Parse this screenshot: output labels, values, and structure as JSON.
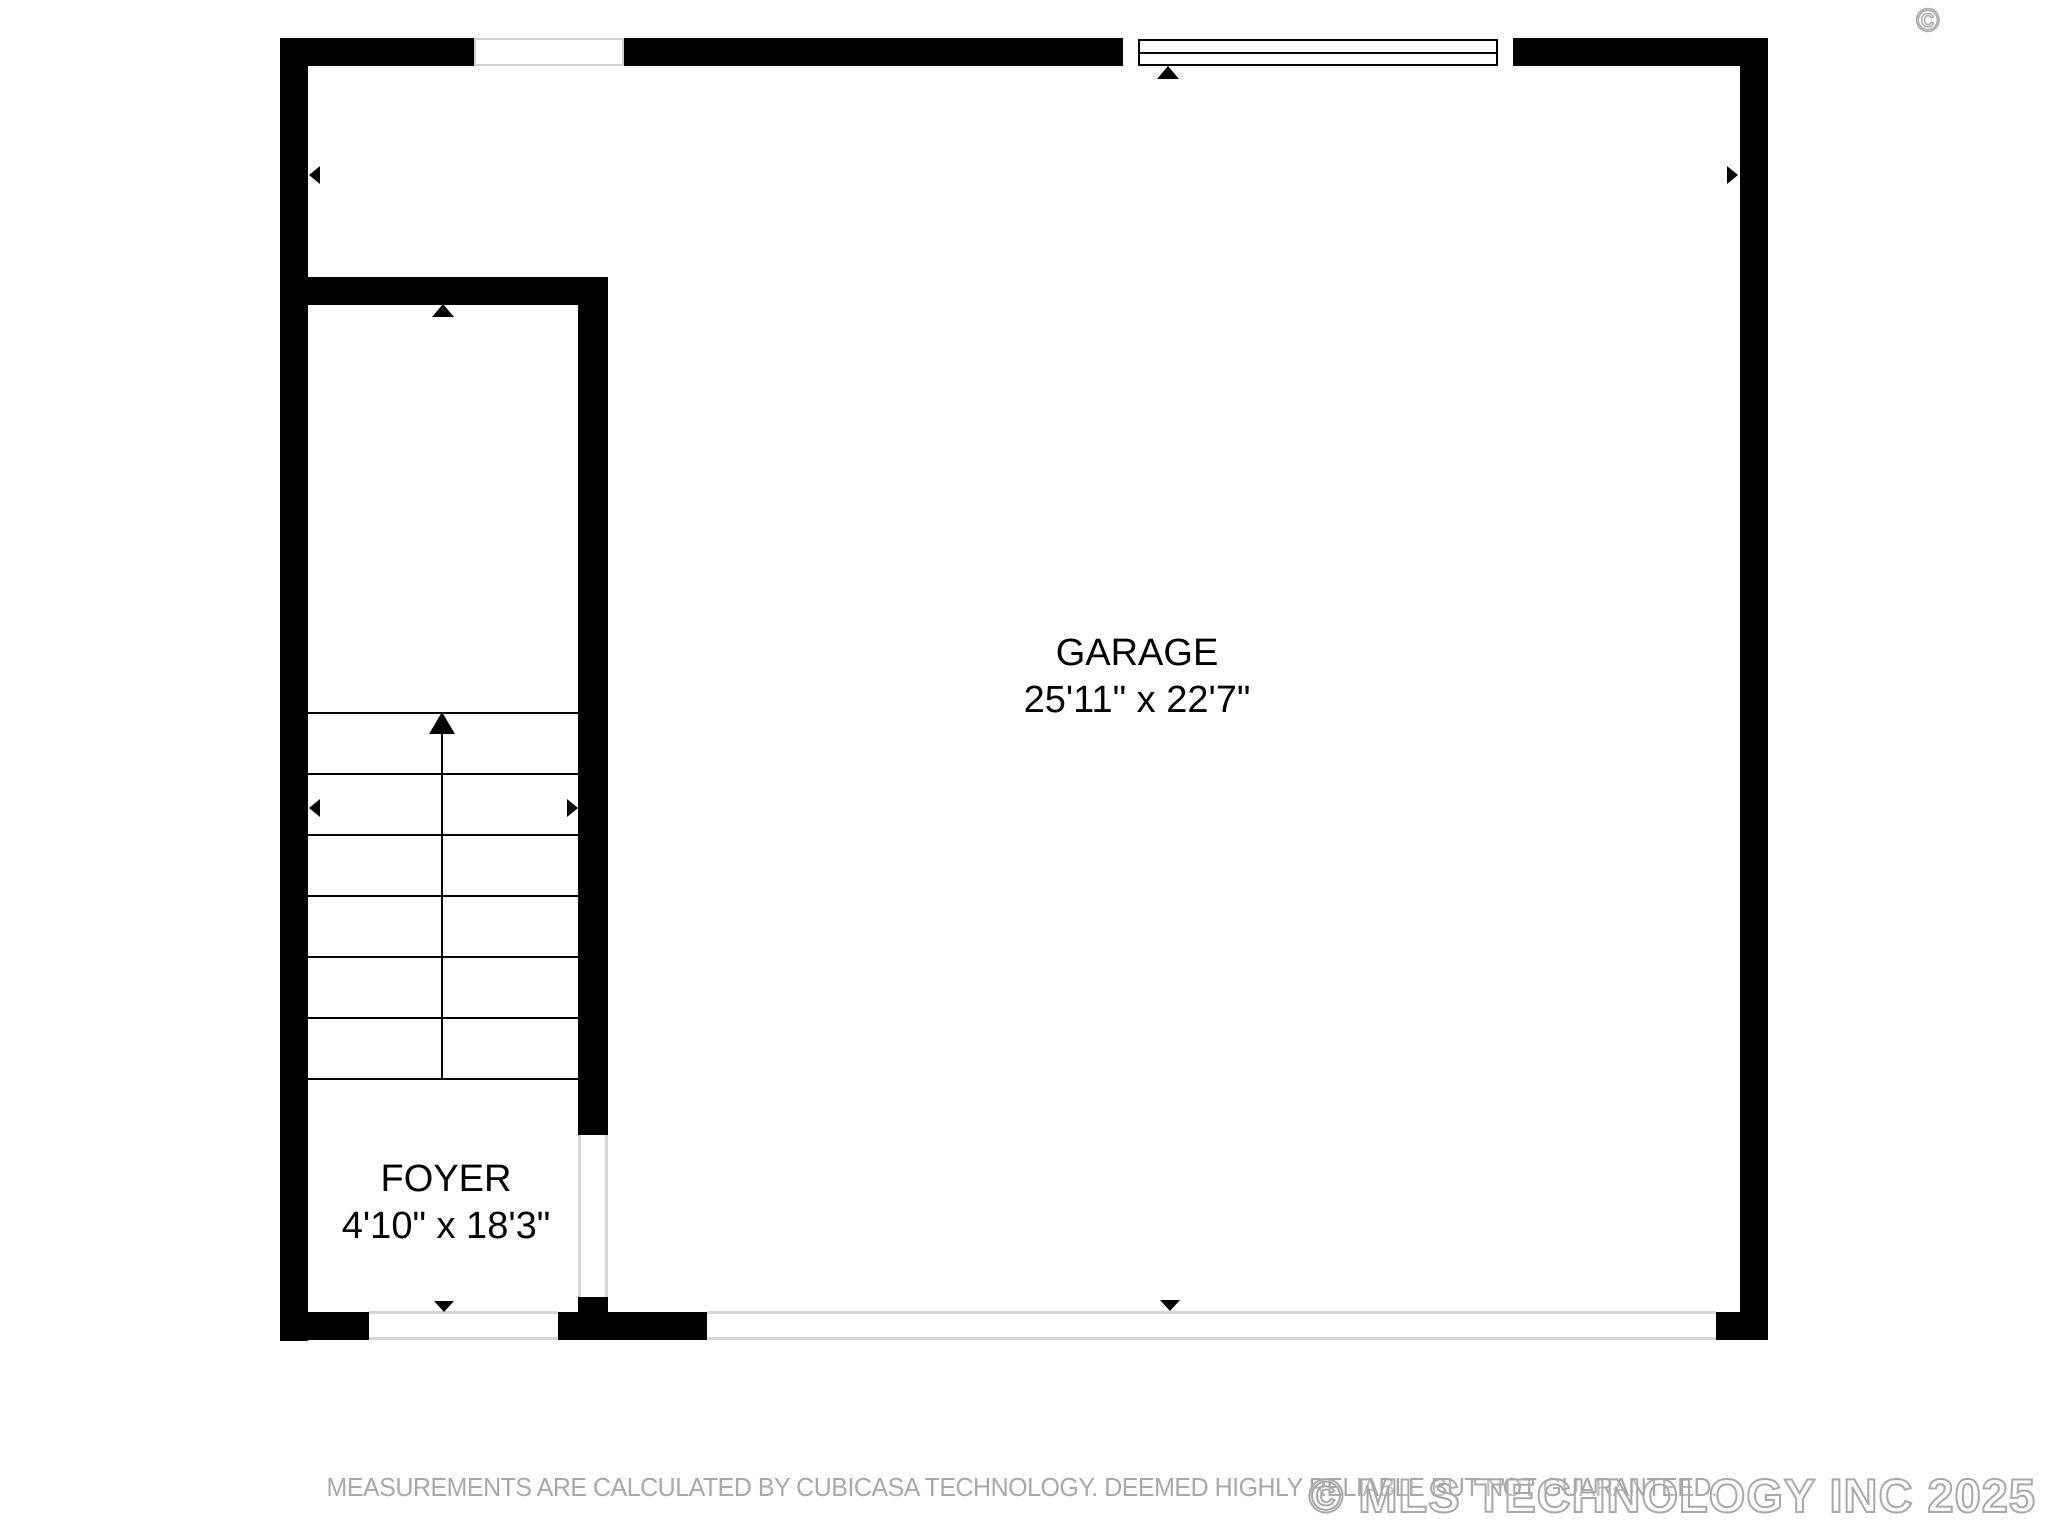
{
  "plan": {
    "rooms": [
      {
        "name": "GARAGE",
        "dimensions": "25'11\" x 22'7\""
      },
      {
        "name": "FOYER",
        "dimensions": "4'10\" x 18'3\""
      }
    ]
  },
  "footer": {
    "disclaimer": "MEASUREMENTS ARE CALCULATED BY CUBICASA TECHNOLOGY. DEEMED HIGHLY RELIABLE BUT NOT GUARANTEED.",
    "watermark": "© MLS TECHNOLOGY INC 2025",
    "watermark_symbol": "©"
  },
  "colors": {
    "wall": "#000000",
    "opening_line": "#d6d6d6",
    "window_border": "#d0d0d0",
    "disclaimer_text": "#a8a8a8",
    "watermark_outline": "#a8a8a8",
    "background": "#ffffff"
  }
}
